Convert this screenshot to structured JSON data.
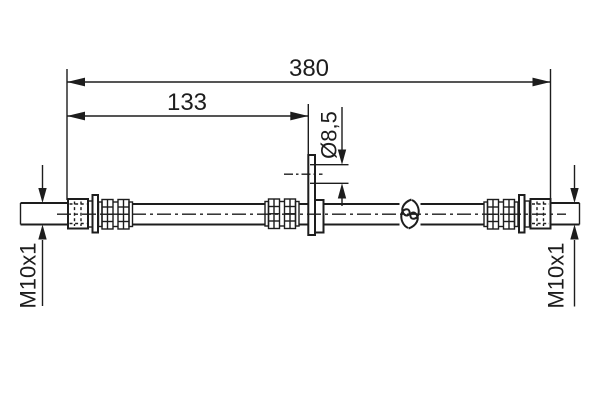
{
  "drawing": {
    "kind": "brake-hose technical drawing",
    "labels": {
      "overall_length": "380",
      "end_to_bracket_length": "133",
      "bracket_hole_diameter": "Ø8,5",
      "left_thread": "M10x1",
      "right_thread": "M10x1"
    },
    "colors": {
      "line": "#1d1d1d",
      "background": "#ffffff"
    }
  }
}
